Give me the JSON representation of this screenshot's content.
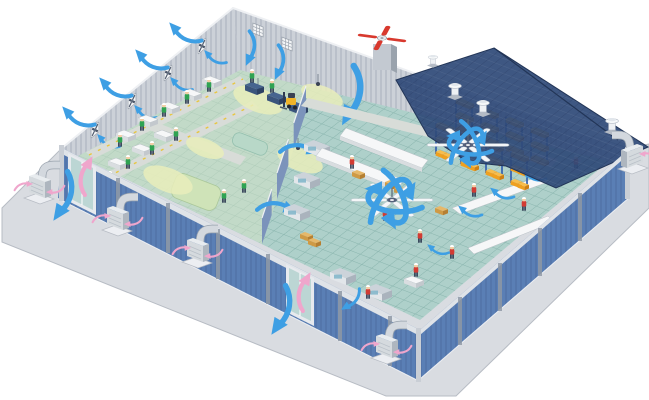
{
  "scene": {
    "alt": "Isometric cutaway illustration of a factory building showing industrial ventilation and cooling: wall exhaust fans and intake grilles with blue airflow arrows, roof cowl vents, a rooftop red-blade exhaust fan, two large HVLS ceiling fans, external evaporative cooler units with ducts, open doorways with blue and pink air-exchange arrows, a production hall with workers in green hi-vis vests, and a warehouse hall with workers in red shirts and pallet racking holding orange boxes."
  },
  "palette": {
    "bg": "#ffffff",
    "apron": "#d9dce1",
    "apron_edge": "#b7bcc4",
    "pad": "#eceef2",
    "wall_gray": "#ccd1d8",
    "wall_trim": "#eef0f3",
    "wall_blue": "#5a7fb5",
    "wall_band": "#dfe3e8",
    "wall_post": "#8f99a6",
    "roof_navy": "#2f4a78",
    "roof_edge": "#223557",
    "floor_teal": "#aed0ca",
    "floor_grid": "#8ab5ae",
    "hall_tint": "#d6e4c6",
    "walkway": "#d8dcd8",
    "walkway_tick": "#e8c63f",
    "divider": "#7b93bb",
    "arrow_blue": "#3e9fe4",
    "arrow_pink": "#efa6cc",
    "glow": "#e9edbb",
    "mat_green": "#cfe3b8",
    "mat_teal": "#b8d8c8",
    "vest_green": "#2fa352",
    "shirt_red": "#d23b33",
    "skin": "#f3cfa6",
    "worker_dark": "#2e3a52",
    "table_top": "#f6f7f8",
    "table_front": "#d9dde0",
    "table_side": "#c3c8cd",
    "box_orange": "#efa01f",
    "box_tan": "#cf9a45",
    "rack_blue": "#3a66b0",
    "cooler_body": "#d5dade",
    "cooler_side": "#aeb6bf",
    "fan_white": "#f4f6f8",
    "fan_red": "#d8392e",
    "fan_hub": "#55607a",
    "machine_blue": "#46648f",
    "forklift_yellow": "#f0b429",
    "door_frame": "#e7eaee",
    "door_glass": "#bcd6d4"
  },
  "legend": {
    "wall-exhaust-fan": "white box fan with X blades on gray mesh wall, blue out-flow arrows",
    "intake-grille": "white louvered grille on back wall with blue in-flow arrow",
    "roof-cowl-vent": "white cylindrical vent with cap on navy roof",
    "rooftop-exhaust-fan": "red four-blade fan on gray pedestal at roof edge",
    "hvls-ceiling-fan": "large white six-blade ceiling fan with circular blue airflow arrows",
    "evaporative-cooler": "gray ducted cooling unit on concrete pad with pink heat arrows",
    "loading-door": "wall doorway with blue cool-air and pink warm-air curved arrows",
    "pallet-rack": "blue rack frames stacked with orange boxes",
    "worker-green": "operator in green hi-vis vest (production hall)",
    "worker-red": "operator in red shirt (warehouse hall)",
    "forklift": "yellow forklift truck"
  }
}
